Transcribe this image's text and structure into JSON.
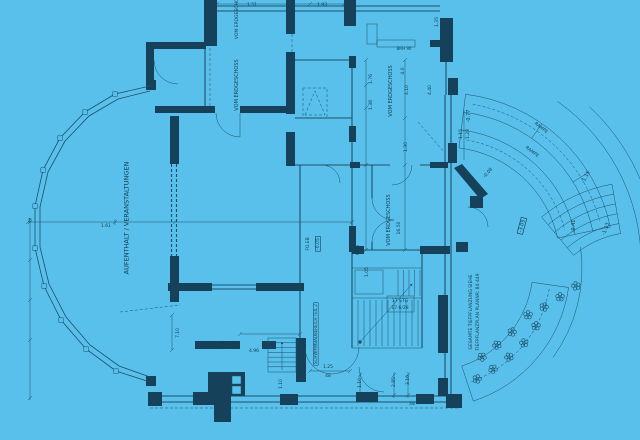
{
  "drawing": {
    "kind": "architectural blueprint floor plan",
    "language": "German"
  },
  "colors": {
    "background": "#58c0ea",
    "line": "#1d4f6a",
    "wall_fill": "#16415a",
    "text": "#123c52"
  },
  "annotations": [
    {
      "name": "room-label-aufenthalt-veranstaltungen",
      "text": "AUFENTHALT / VERANSTALTUNGEN",
      "x": 127,
      "y": 218,
      "rot": -90,
      "size": 6.5
    },
    {
      "name": "room-label-vom-erdgeschoss-1",
      "text": "VOM ERDGESCHOSS",
      "x": 237,
      "y": 16,
      "rot": -90,
      "size": 4.5
    },
    {
      "name": "room-label-vom-erdgeschoss-2",
      "text": "VOM ERDGESCHOSS",
      "x": 237,
      "y": 85,
      "rot": -90,
      "size": 5
    },
    {
      "name": "room-label-vom-erdgeschoss-3",
      "text": "VOM ERDGESCHOSS",
      "x": 391,
      "y": 91,
      "rot": -90,
      "size": 5
    },
    {
      "name": "room-label-vom-erdgeschoss-4",
      "text": "VOM ERDGESCHOSS",
      "x": 389,
      "y": 220,
      "rot": -90,
      "size": 5
    },
    {
      "name": "level-label-foeb",
      "text": "FO.EB",
      "x": 308,
      "y": 244,
      "rot": -90,
      "size": 4.5
    },
    {
      "name": "level-label-minus-005",
      "text": "-0.05",
      "x": 318,
      "y": 244,
      "rot": -90,
      "size": 4.5,
      "boxed": true
    },
    {
      "name": "level-label-minus-077",
      "text": "-0.77",
      "x": 469,
      "y": 116,
      "rot": -90,
      "size": 5
    },
    {
      "name": "level-label-minus-008",
      "text": "-0.08",
      "x": 488,
      "y": 173,
      "rot": -50,
      "size": 4.5
    },
    {
      "name": "level-label-minus-115",
      "text": "-1.15",
      "x": 586,
      "y": 177,
      "rot": -62,
      "size": 5
    },
    {
      "name": "level-label-minus-041",
      "text": "-0.41",
      "x": 574,
      "y": 226,
      "rot": -90,
      "size": 5
    },
    {
      "name": "level-label-minus-113",
      "text": "-1.13",
      "x": 606,
      "y": 229,
      "rot": -70,
      "size": 5
    },
    {
      "name": "level-label-minus-305",
      "text": "-3.05",
      "x": 522,
      "y": 226,
      "rot": -75,
      "size": 5,
      "boxed": true
    },
    {
      "name": "ramp-label-1",
      "text": "RAMPE",
      "x": 541,
      "y": 128,
      "rot": 38,
      "size": 4.5
    },
    {
      "name": "ramp-label-2",
      "text": "RAMPE",
      "x": 532,
      "y": 152,
      "rot": 38,
      "size": 4.5
    },
    {
      "name": "planting-note-line1",
      "text": "GESAMTE TIEFPFLANZUNG SIEHE",
      "x": 471,
      "y": 312,
      "rot": -90,
      "size": 4.5
    },
    {
      "name": "planting-note-line2",
      "text": "TIEFPFLANZPLAN PLANNR: 84-449",
      "x": 478,
      "y": 312,
      "rot": -90,
      "size": 4.5
    },
    {
      "name": "area-label-schwimmbadbereich",
      "text": "SCHWIMMBADBEREICH TEIL 2",
      "x": 316,
      "y": 334,
      "rot": -90,
      "size": 4,
      "boxed": true
    },
    {
      "name": "stair-label-line1",
      "text": "17 STG",
      "x": 400,
      "y": 301,
      "rot": 0,
      "size": 4.5
    },
    {
      "name": "stair-label-line2",
      "text": "17.6/28",
      "x": 400,
      "y": 308,
      "rot": 0,
      "size": 4.5
    },
    {
      "name": "dim-176",
      "text": "1.76",
      "x": 371,
      "y": 79,
      "rot": -90,
      "size": 4.5
    },
    {
      "name": "dim-40",
      "text": "4.0",
      "x": 403,
      "y": 71,
      "rot": -90,
      "size": 4.5
    },
    {
      "name": "dim-138",
      "text": "1.38",
      "x": 371,
      "y": 105,
      "rot": -90,
      "size": 4.5
    },
    {
      "name": "dim-410",
      "text": "4.10",
      "x": 407,
      "y": 90,
      "rot": -90,
      "size": 4.5
    },
    {
      "name": "dim-440",
      "text": "4.40",
      "x": 430,
      "y": 90,
      "rot": -90,
      "size": 4.5
    },
    {
      "name": "dim-1650",
      "text": "16.50",
      "x": 399,
      "y": 228,
      "rot": -90,
      "size": 4.5
    },
    {
      "name": "dim-636",
      "text": "6.36",
      "x": 358,
      "y": 250,
      "rot": -90,
      "size": 4.5
    },
    {
      "name": "dim-130",
      "text": "1.30",
      "x": 406,
      "y": 147,
      "rot": -90,
      "size": 4.5
    },
    {
      "name": "dim-115",
      "text": "1.15",
      "x": 461,
      "y": 134,
      "rot": -90,
      "size": 4.5
    },
    {
      "name": "dim-128",
      "text": "1.28",
      "x": 468,
      "y": 134,
      "rot": -90,
      "size": 4.5
    },
    {
      "name": "dim-brh90",
      "text": "BRH 90",
      "x": 404,
      "y": 49,
      "rot": 0,
      "size": 4
    },
    {
      "name": "dim-151",
      "text": "1.51",
      "x": 252,
      "y": 5,
      "rot": 0,
      "size": 4.5
    },
    {
      "name": "dim-193",
      "text": "1.93",
      "x": 322,
      "y": 5,
      "rot": 0,
      "size": 4.5
    },
    {
      "name": "dim-135",
      "text": "1.35",
      "x": 437,
      "y": 22,
      "rot": -90,
      "size": 4.5
    },
    {
      "name": "dim-710",
      "text": "7.10",
      "x": 178,
      "y": 333,
      "rot": -90,
      "size": 4.5
    },
    {
      "name": "dim-496",
      "text": "4.96",
      "x": 254,
      "y": 351,
      "rot": 0,
      "size": 4.5
    },
    {
      "name": "dim-0526",
      "text": "0.5/26",
      "x": 228,
      "y": 344,
      "rot": 0,
      "size": 4
    },
    {
      "name": "dim-125",
      "text": "1.25",
      "x": 328,
      "y": 367,
      "rot": 0,
      "size": 4.5
    },
    {
      "name": "dim-48a",
      "text": "48",
      "x": 328,
      "y": 376,
      "rot": 0,
      "size": 4.5
    },
    {
      "name": "dim-110a",
      "text": "1.10",
      "x": 281,
      "y": 384,
      "rot": -90,
      "size": 4.5
    },
    {
      "name": "dim-110b",
      "text": "1.10",
      "x": 360,
      "y": 383,
      "rot": -90,
      "size": 4.5
    },
    {
      "name": "dim-285",
      "text": "2.85",
      "x": 394,
      "y": 382,
      "rot": -90,
      "size": 4.5
    },
    {
      "name": "dim-310",
      "text": "3.10",
      "x": 408,
      "y": 380,
      "rot": -90,
      "size": 4.5
    },
    {
      "name": "dim-48b",
      "text": "48",
      "x": 412,
      "y": 404,
      "rot": 0,
      "size": 4.5
    },
    {
      "name": "axis-label-e",
      "text": "E",
      "x": 30,
      "y": 221,
      "rot": 0,
      "size": 5.5
    },
    {
      "name": "dim-161",
      "text": "1.61",
      "x": 106,
      "y": 226,
      "rot": 0,
      "size": 4.5
    },
    {
      "name": "dim-105",
      "text": "1.05",
      "x": 367,
      "y": 272,
      "rot": -90,
      "size": 4.5
    }
  ],
  "planting": {
    "flowers": [
      [
        544,
        307
      ],
      [
        536,
        326
      ],
      [
        524,
        343
      ],
      [
        509,
        357
      ],
      [
        493,
        369
      ],
      [
        477,
        379
      ],
      [
        560,
        297
      ],
      [
        576,
        286
      ],
      [
        497,
        345
      ],
      [
        482,
        357
      ],
      [
        512,
        332
      ],
      [
        528,
        315
      ]
    ]
  }
}
